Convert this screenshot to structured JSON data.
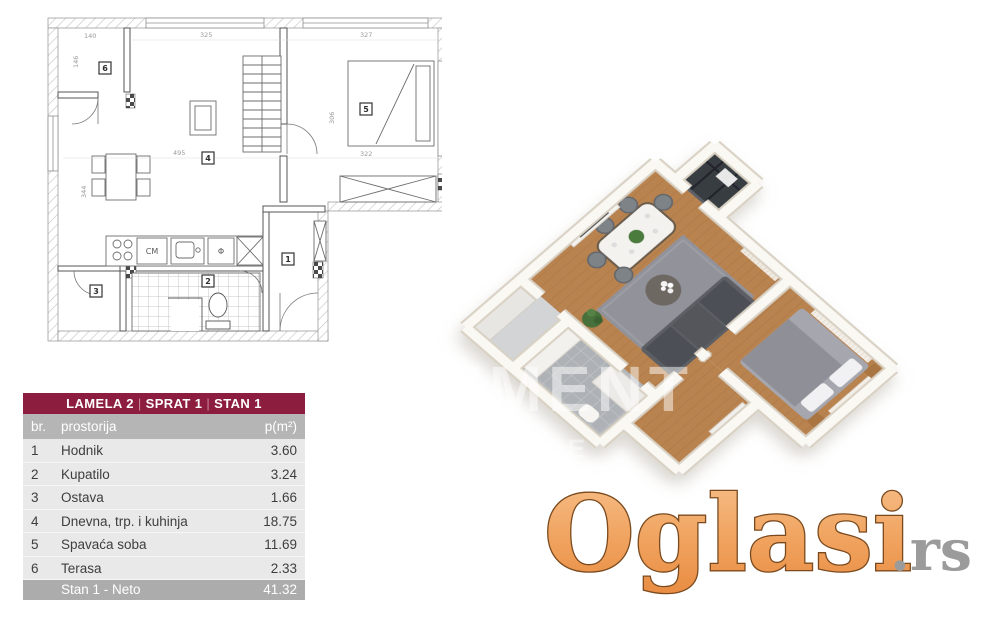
{
  "table": {
    "title_parts": [
      "LAMELA 2",
      "SPRAT 1",
      "STAN 1"
    ],
    "separator": "|",
    "columns": [
      "br.",
      "prostorija",
      "p(m²)"
    ],
    "rows": [
      {
        "br": "1",
        "prostorija": "Hodnik",
        "p": "3.60"
      },
      {
        "br": "2",
        "prostorija": "Kupatilo",
        "p": "3.24"
      },
      {
        "br": "3",
        "prostorija": "Ostava",
        "p": "1.66"
      },
      {
        "br": "4",
        "prostorija": "Dnevna, trp. i kuhinja",
        "p": "18.75"
      },
      {
        "br": "5",
        "prostorija": "Spavaća soba",
        "p": "11.69"
      },
      {
        "br": "6",
        "prostorija": "Terasa",
        "p": "2.33"
      }
    ],
    "footer": {
      "label": "Stan 1 - Neto",
      "value": "41.32"
    },
    "colors": {
      "header_bg": "#8d1d3f",
      "subheader_bg": "#b5b5b5",
      "row_bg": "#e9e9e9",
      "footer_bg": "#acacac"
    }
  },
  "floorplan_2d": {
    "room_numbers": [
      "1",
      "2",
      "3",
      "4",
      "5",
      "6"
    ],
    "dimensions": {
      "terrace_width": "140",
      "terrace_height": "146",
      "top_left": "325",
      "top_right": "327",
      "living_width": "495",
      "living_height": "344",
      "bedroom_height": "306",
      "bedroom_width": "322"
    },
    "fixtures": {
      "washing_machine": "CM",
      "dishwasher": "Φ"
    }
  },
  "render_3d": {
    "watermark_line1": "EMENT",
    "watermark_line2": "NINE"
  },
  "site_watermark": {
    "brand": "Oglasi",
    "tld": ".rs",
    "brand_color_top": "#f7c08b",
    "brand_color_bottom": "#e98c42",
    "tld_color": "#9b9b9b"
  }
}
